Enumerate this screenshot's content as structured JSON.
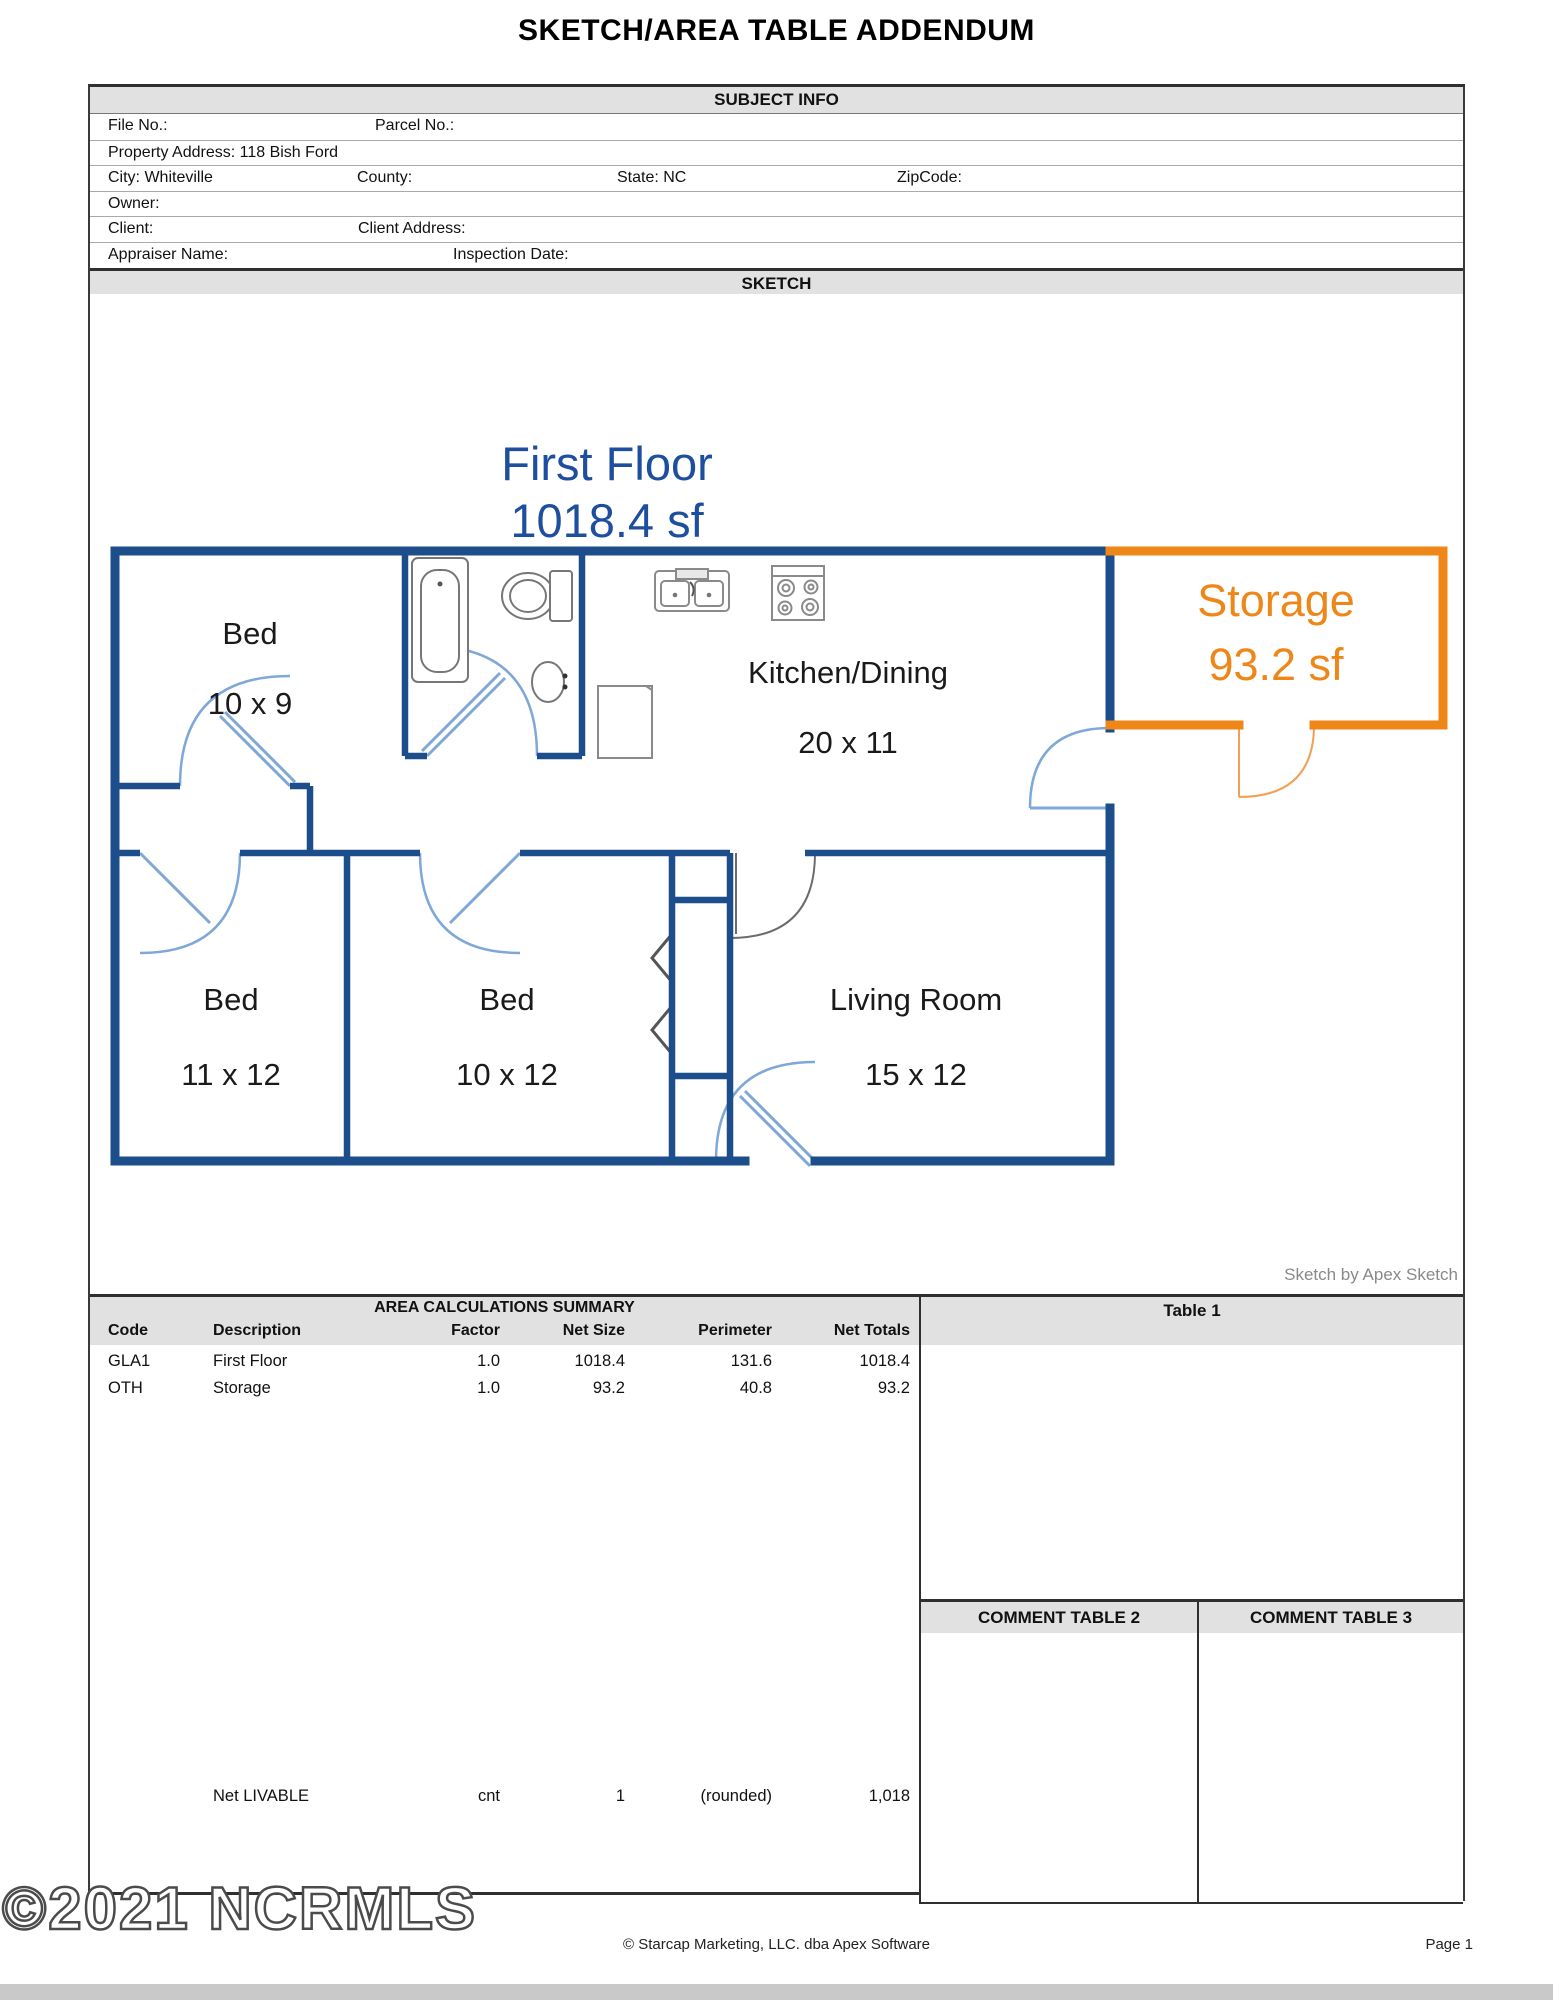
{
  "page": {
    "title": "SKETCH/AREA TABLE ADDENDUM",
    "watermark": "©2021 NCRMLS",
    "footer_center": "© Starcap Marketing, LLC. dba Apex Software",
    "footer_page": "Page 1"
  },
  "subject_info": {
    "header": "SUBJECT INFO",
    "file_no": "File No.:",
    "parcel_no": "Parcel No.:",
    "property_address": "Property Address: 118 Bish Ford",
    "city": "City: Whiteville",
    "county": "County:",
    "state": "State: NC",
    "zipcode": "ZipCode:",
    "owner": "Owner:",
    "client": "Client:",
    "client_address": "Client Address:",
    "appraiser_name": "Appraiser Name:",
    "inspection_date": "Inspection Date:"
  },
  "sketch": {
    "header": "SKETCH",
    "floor_title": "First Floor",
    "floor_area": "1018.4 sf",
    "credit": "Sketch by Apex Sketch",
    "colors": {
      "wall": "#1b4e8a",
      "door": "#7fa8d8",
      "storage": "#ef8618",
      "title_blue": "#1d4f9e"
    },
    "rooms": [
      {
        "name": "Bed",
        "dims": "10 x 9"
      },
      {
        "name": "Kitchen/Dining",
        "dims": "20 x 11"
      },
      {
        "name": "Storage",
        "dims": "93.2 sf"
      },
      {
        "name": "Bed",
        "dims": "11 x 12"
      },
      {
        "name": "Bed",
        "dims": "10 x 12"
      },
      {
        "name": "Living Room",
        "dims": "15 x 12"
      }
    ]
  },
  "area_summary": {
    "header": "AREA CALCULATIONS SUMMARY",
    "columns": [
      "Code",
      "Description",
      "Factor",
      "Net Size",
      "Perimeter",
      "Net Totals"
    ],
    "rows": [
      {
        "code": "GLA1",
        "description": "First Floor",
        "factor": "1.0",
        "net_size": "1018.4",
        "perimeter": "131.6",
        "net_totals": "1018.4"
      },
      {
        "code": "OTH",
        "description": "Storage",
        "factor": "1.0",
        "net_size": "93.2",
        "perimeter": "40.8",
        "net_totals": "93.2"
      }
    ],
    "net_livable": {
      "label": "Net LIVABLE",
      "factor": "cnt",
      "net_size": "1",
      "note": "(rounded)",
      "total": "1,018"
    }
  },
  "tables": {
    "table1_header": "Table 1",
    "comment2_header": "COMMENT TABLE 2",
    "comment3_header": "COMMENT TABLE 3"
  }
}
